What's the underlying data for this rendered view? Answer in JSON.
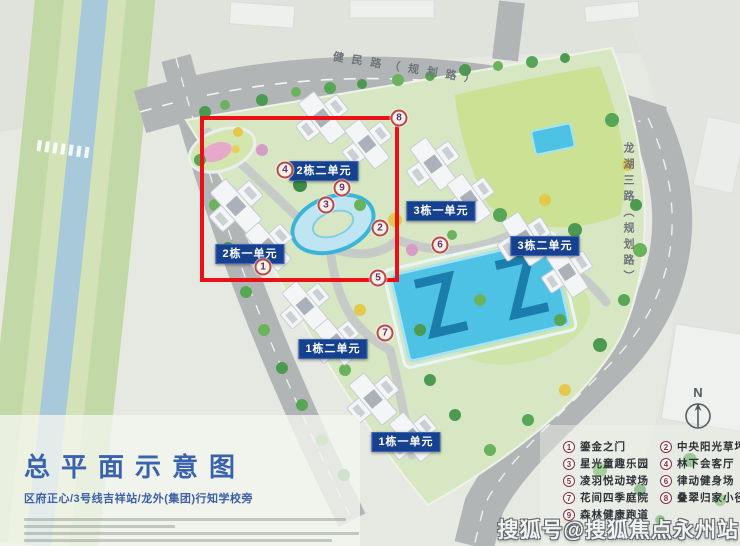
{
  "title": {
    "text": "总平面示意图",
    "subtitle": "区府正心/3号线吉祥站/龙外(集团)行知学校旁"
  },
  "roads": {
    "top": "健民路（规划路）",
    "right": "龙湖三路（规划路）"
  },
  "north_label": "N",
  "unit_labels": [
    {
      "text": "2栋二单元",
      "x": 324,
      "y": 171
    },
    {
      "text": "2栋一单元",
      "x": 250,
      "y": 254
    },
    {
      "text": "3栋一单元",
      "x": 441,
      "y": 211
    },
    {
      "text": "3栋二单元",
      "x": 545,
      "y": 246
    },
    {
      "text": "1栋二单元",
      "x": 333,
      "y": 349
    },
    {
      "text": "1栋一单元",
      "x": 406,
      "y": 442
    }
  ],
  "map_markers": [
    {
      "n": "1",
      "x": 263,
      "y": 267
    },
    {
      "n": "2",
      "x": 380,
      "y": 228
    },
    {
      "n": "3",
      "x": 326,
      "y": 205
    },
    {
      "n": "4",
      "x": 285,
      "y": 170
    },
    {
      "n": "5",
      "x": 378,
      "y": 278
    },
    {
      "n": "6",
      "x": 440,
      "y": 245
    },
    {
      "n": "7",
      "x": 385,
      "y": 333
    },
    {
      "n": "8",
      "x": 399,
      "y": 118
    },
    {
      "n": "9",
      "x": 342,
      "y": 188
    }
  ],
  "legend": {
    "items": [
      {
        "num": "1",
        "label": "鎏金之门"
      },
      {
        "num": "2",
        "label": "中央阳光草坪"
      },
      {
        "num": "3",
        "label": "星光童趣乐园"
      },
      {
        "num": "4",
        "label": "林下会客厅"
      },
      {
        "num": "5",
        "label": "凌羽悦动球场"
      },
      {
        "num": "6",
        "label": "律动健身场"
      },
      {
        "num": "7",
        "label": "花间四季庭院"
      },
      {
        "num": "8",
        "label": "叠翠归家小径"
      },
      {
        "num": "9",
        "label": "森林健康跑道"
      }
    ]
  },
  "watermark": "搜狐号@搜狐焦点永州站",
  "colors": {
    "highlight_red": "#ea1016",
    "label_blue": "#16418f",
    "title_blue": "#3a63ad",
    "badge_ring": "#b9474e",
    "badge_number": "#5e2c80",
    "legend_ring": "#8d2f3c",
    "pool_cyan": "#4ec2e4"
  }
}
